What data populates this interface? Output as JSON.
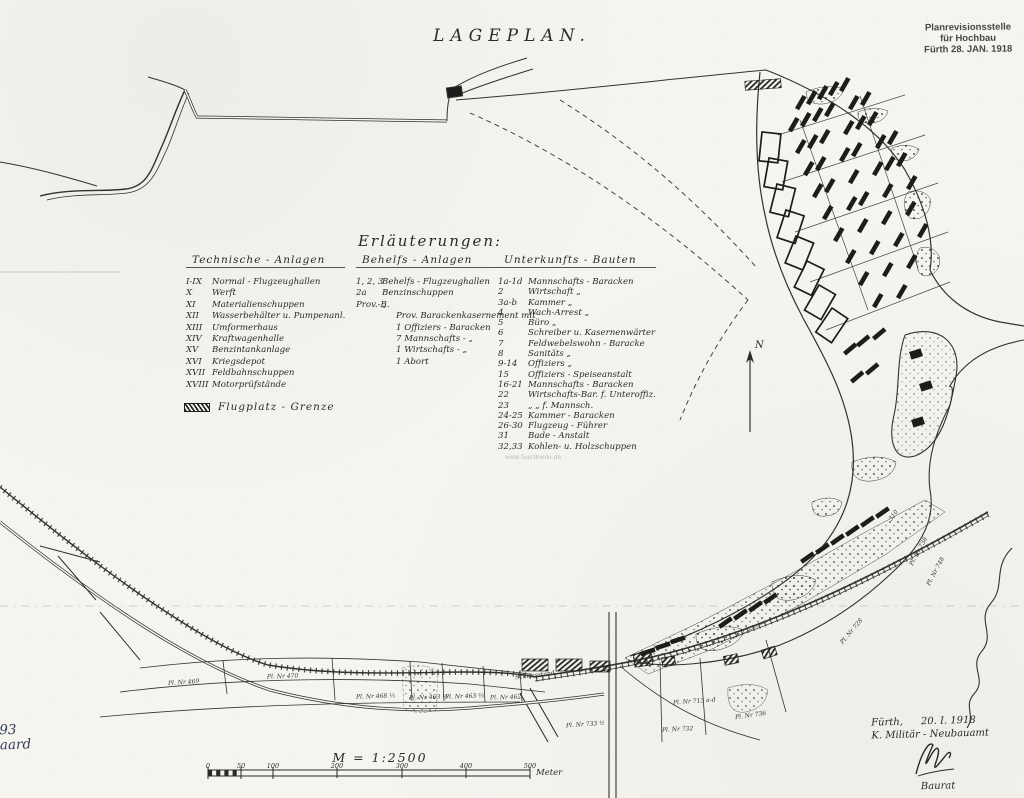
{
  "title": "LAGEPLAN.",
  "stamp": {
    "line1": "Planrevisionsstelle",
    "line2": "für Hochbau",
    "line3": "Fürth 28. JAN. 1918"
  },
  "legend": {
    "heading": "Erläuterungen:",
    "boundary_label": "Flugplatz - Grenze",
    "columns": [
      {
        "header": "Technische - Anlagen",
        "items": [
          {
            "no": "I-IX",
            "label": "Normal - Flugzeughallen"
          },
          {
            "no": "X",
            "label": "Werft"
          },
          {
            "no": "XI",
            "label": "Materialienschuppen"
          },
          {
            "no": "XII",
            "label": "Wasserbehälter u. Pumpenanl."
          },
          {
            "no": "XIII",
            "label": "Umformerhaus"
          },
          {
            "no": "XIV",
            "label": "Kraftwagenhalle"
          },
          {
            "no": "XV",
            "label": "Benzintankanlage"
          },
          {
            "no": "XVI",
            "label": "Kriegsdepot"
          },
          {
            "no": "XVII",
            "label": "Feldbahnschuppen"
          },
          {
            "no": "XVIII",
            "label": "Motorprüfstände"
          }
        ]
      },
      {
        "header": "Behelfs - Anlagen",
        "items": [
          {
            "no": "1, 2, 3",
            "label": "Behelfs - Flugzeughallen"
          },
          {
            "no": "2a",
            "label": "Benzinschuppen"
          },
          {
            "no": "Prov.-B.",
            "label": "„"
          },
          {
            "no": "",
            "label": "Prov. Barackenkasernement mit",
            "ind": true
          },
          {
            "no": "",
            "label": "1 Offiziers  -  Baracken",
            "ind": true
          },
          {
            "no": "",
            "label": "7 Mannschafts -   „",
            "ind": true
          },
          {
            "no": "",
            "label": "1 Wirtschafts  -   „",
            "ind": true
          },
          {
            "no": "",
            "label": "1 Abort",
            "ind": true
          }
        ]
      },
      {
        "header": "Unterkunfts - Bauten",
        "items": [
          {
            "no": "1a-1d",
            "label": "Mannschafts - Baracken"
          },
          {
            "no": "2",
            "label": "Wirtschaft   „"
          },
          {
            "no": "3a-b",
            "label": "Kammer   „"
          },
          {
            "no": "4",
            "label": "Wach-Arrest   „"
          },
          {
            "no": "5",
            "label": "Büro   „"
          },
          {
            "no": "6",
            "label": "Schreiber u. Kasernenwärter"
          },
          {
            "no": "7",
            "label": "Feldwebelswohn - Baracke"
          },
          {
            "no": "8",
            "label": "Sanitäts   „"
          },
          {
            "no": "9-14",
            "label": "Offiziers   „"
          },
          {
            "no": "15",
            "label": "Offiziers - Speiseanstalt"
          },
          {
            "no": "16-21",
            "label": "Mannschafts - Baracken"
          },
          {
            "no": "22",
            "label": "Wirtschafts-Bar. f. Unteroffiz."
          },
          {
            "no": "23",
            "label": "„    „    f. Mannsch."
          },
          {
            "no": "24-25",
            "label": "Kammer - Baracken"
          },
          {
            "no": "26-30",
            "label": "Flugzeug - Führer"
          },
          {
            "no": "31",
            "label": "Bade - Anstalt"
          },
          {
            "no": "32,33",
            "label": "Kohlen- u. Holzschuppen"
          }
        ]
      }
    ]
  },
  "north_label": "N",
  "scale": {
    "text": "M = 1:2500",
    "ticks": [
      "0",
      "50",
      "100",
      "200",
      "300",
      "400",
      "500"
    ],
    "unit": "Meter"
  },
  "signature": {
    "city": "Fürth,",
    "date": "20. I. 1918",
    "office": "K. Militär - Neubauamt",
    "title": "Baurat"
  },
  "margin_note": {
    "number": "393",
    "name": "gaard"
  },
  "watermark": "www.fuerthwiki.de",
  "plot_labels": [
    {
      "text": "Pl. Nr 469",
      "x": 168,
      "y": 679,
      "rot": -4
    },
    {
      "text": "Pl. Nr 470",
      "x": 267,
      "y": 673,
      "rot": -2
    },
    {
      "text": "Pl. Nr 468 ⅓",
      "x": 356,
      "y": 693,
      "rot": -2
    },
    {
      "text": "Pl. Nr 463 ⅓",
      "x": 409,
      "y": 694,
      "rot": -2
    },
    {
      "text": "Pl. Nr 463 ⅔",
      "x": 445,
      "y": 693,
      "rot": -2
    },
    {
      "text": "Pl. Nr 462",
      "x": 490,
      "y": 694,
      "rot": -2
    },
    {
      "text": "Schiessstand",
      "x": 515,
      "y": 672,
      "rot": -7
    },
    {
      "text": "Pl. Nr 713 a-d",
      "x": 673,
      "y": 698,
      "rot": -4
    },
    {
      "text": "Pl. Nr 733 ½",
      "x": 566,
      "y": 721,
      "rot": -4
    },
    {
      "text": "Pl. Nr 732",
      "x": 662,
      "y": 726,
      "rot": -3
    },
    {
      "text": "Pl. Nr 736",
      "x": 735,
      "y": 712,
      "rot": -8
    },
    {
      "text": "Pl. Nr 738",
      "x": 903,
      "y": 548,
      "rot": -62
    },
    {
      "text": "Pl. Nr 748",
      "x": 920,
      "y": 568,
      "rot": -62
    },
    {
      "text": "Pl. Nr 728",
      "x": 836,
      "y": 628,
      "rot": -50
    },
    {
      "text": "310",
      "x": 888,
      "y": 512,
      "rot": -55
    }
  ],
  "colors": {
    "ink": "#2b2a27",
    "paper": "#f5f4ef",
    "stamp": "#474745",
    "note": "#323d58"
  }
}
